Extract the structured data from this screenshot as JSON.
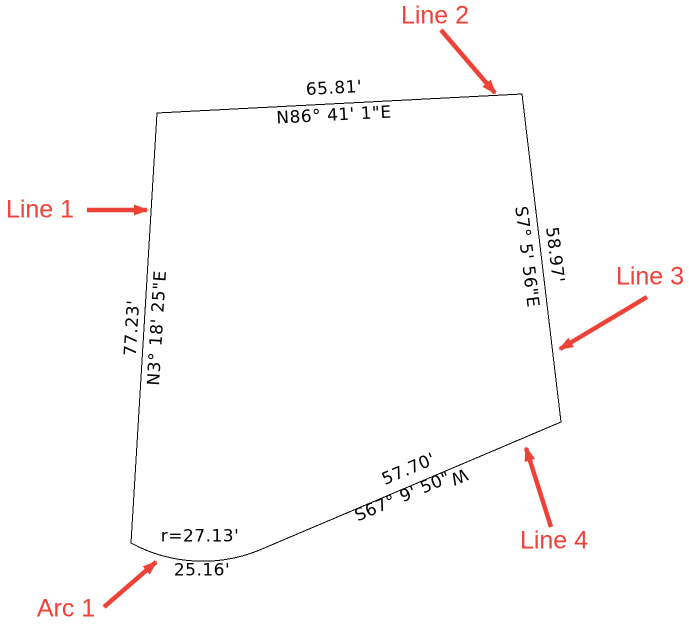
{
  "figure": {
    "type": "plat-survey-diagram",
    "background_color": "#ffffff",
    "boundary_color": "#000000",
    "callout_color": "#ee4238"
  },
  "labels": {
    "line1_length": "77.23'",
    "line1_bearing": "N3° 18' 25\"E",
    "line2_length": "65.81'",
    "line2_bearing": "N86° 41' 1\"E",
    "line3_length": "58.97'",
    "line3_bearing": "S7° 5' 56\"E",
    "line4_length": "57.70'",
    "line4_bearing": "S67° 9' 50\"",
    "line4_bearing_suffix": "W",
    "arc1_radius": "r=27.13'",
    "arc1_length": "25.16'"
  },
  "callouts": {
    "line1": "Line 1",
    "line2": "Line 2",
    "line3": "Line 3",
    "line4": "Line 4",
    "arc1": "Arc 1"
  }
}
